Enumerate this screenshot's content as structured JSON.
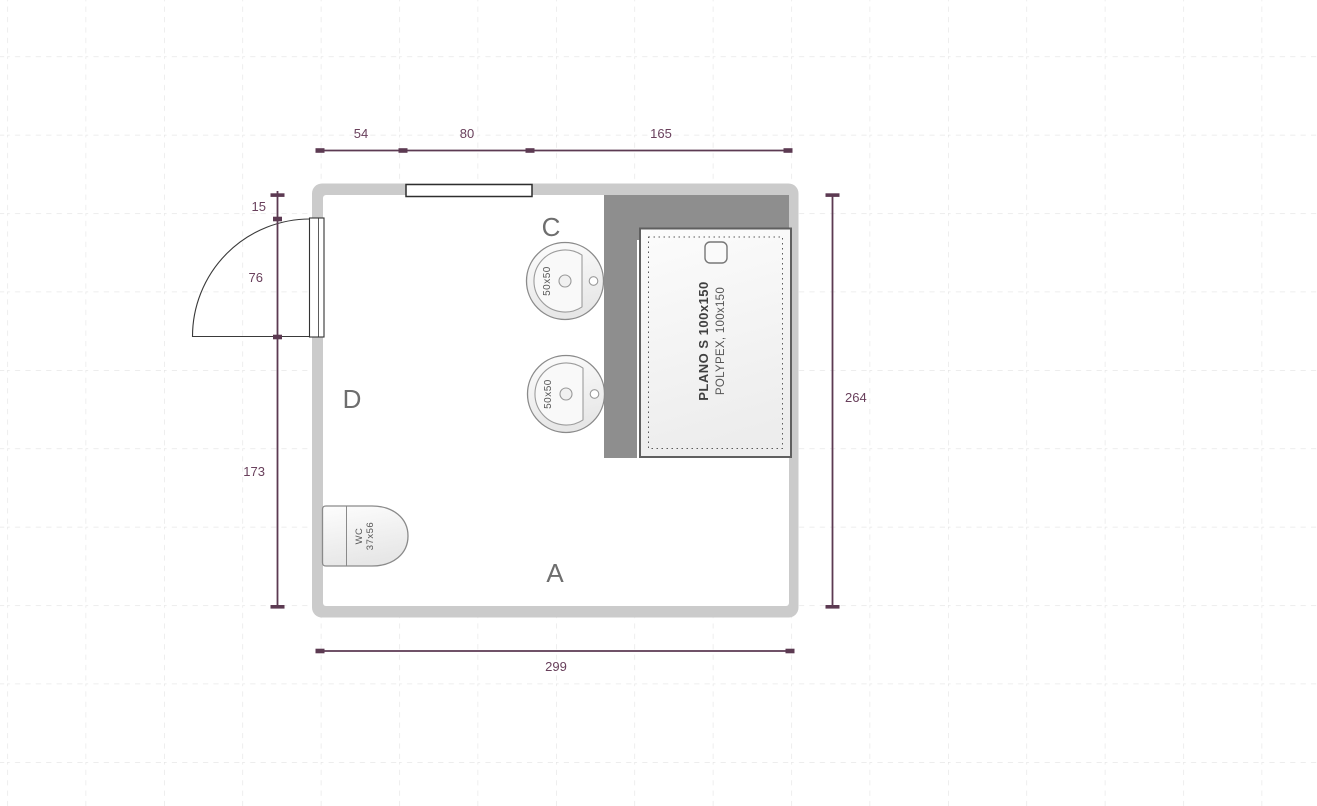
{
  "plan": {
    "dims": {
      "top_54": "54",
      "top_80": "80",
      "top_165": "165",
      "left_15": "15",
      "left_76": "76",
      "left_173": "173",
      "right_264": "264",
      "bottom_299": "299"
    },
    "zones": {
      "c": "C",
      "d": "D",
      "a": "A"
    },
    "fixtures": {
      "sink_top_label": "50x50",
      "sink_bottom_label": "50x50",
      "wc_line1": "WC",
      "wc_line2": "37x56",
      "shower_line1": "PLANO S 100x150",
      "shower_line2": "POLYPEX, 100x150"
    },
    "colors": {
      "dimension": "#5c3a52",
      "dimension_text": "#69405c",
      "wall": "#cbcbcb",
      "partition": "#8e8e8e",
      "grid": "#e2e2e2",
      "fixture_outline": "#8a8a8a"
    }
  }
}
